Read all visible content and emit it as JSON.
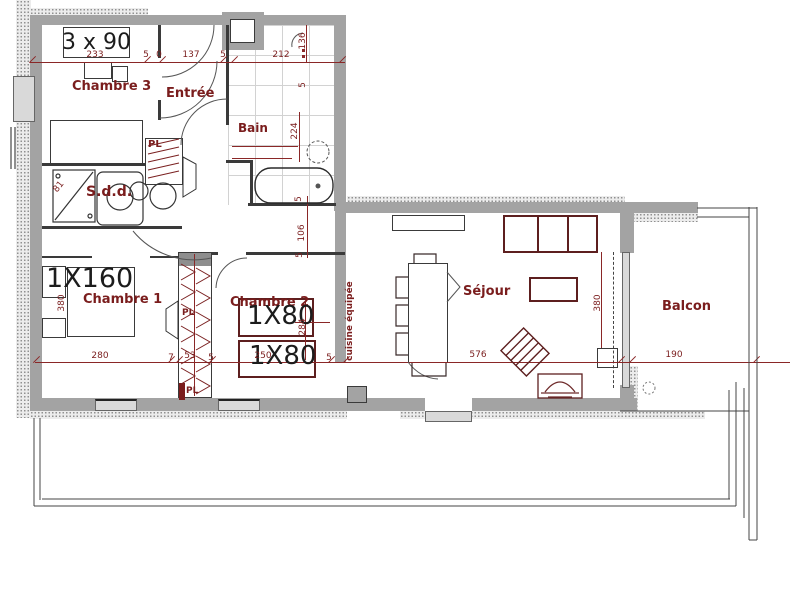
{
  "labels": {
    "chambre3": "Chambre 3",
    "entree": "Entrée",
    "bain": "Bain",
    "sdd": "S.d.d.",
    "chambre1": "Chambre 1",
    "chambre2": "Chambre 2",
    "sejour": "Séjour",
    "balcon": "Balcon",
    "cuisine": "cuisine équipée",
    "pl": "PL"
  },
  "beds": {
    "c3": "3 x 90",
    "c1": "1X160",
    "c2": "1X80"
  },
  "dims": {
    "n233": "233",
    "n0": "0",
    "n5": "5",
    "n137": "137",
    "n212": "212",
    "n136": "136",
    "n224": "224",
    "n106": "106",
    "n81": "81",
    "n284": "284",
    "n380": "380",
    "n280": "280",
    "n7": "7",
    "n53": "53",
    "n250": "250",
    "n576": "576",
    "n190": "190"
  },
  "colors": {
    "wall": "#a3a3a3",
    "stipple": "#8f8f8f",
    "dimension": "#7a1d1d",
    "furniture": "#5d1f1f",
    "glass": "#d9d9d9"
  }
}
